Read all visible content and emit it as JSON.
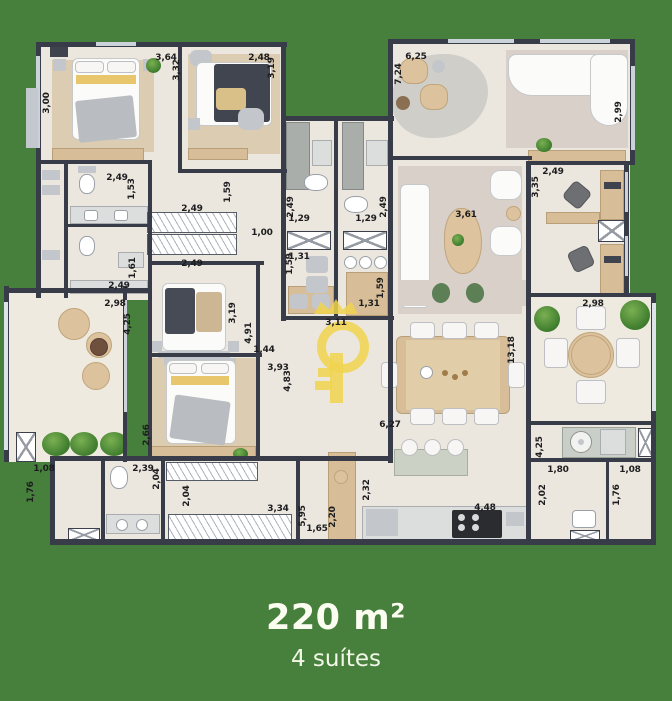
{
  "colors": {
    "background": "#47803c",
    "walls": "#373c48",
    "floor": "#ece7de",
    "watermark": "#f1d44e"
  },
  "footer": {
    "area": "220 m²",
    "suites": "4 suítes"
  },
  "dim_labels": [
    {
      "t": "3,00",
      "x": 47,
      "y": 103,
      "v": 1
    },
    {
      "t": "3,64",
      "x": 166,
      "y": 58,
      "v": 0
    },
    {
      "t": "3,32",
      "x": 177,
      "y": 70,
      "v": 1
    },
    {
      "t": "2,48",
      "x": 259,
      "y": 58,
      "v": 0
    },
    {
      "t": "3,19",
      "x": 272,
      "y": 68,
      "v": 1
    },
    {
      "t": "6,25",
      "x": 416,
      "y": 57,
      "v": 0
    },
    {
      "t": "7,24",
      "x": 399,
      "y": 74,
      "v": 1
    },
    {
      "t": "2,99",
      "x": 619,
      "y": 112,
      "v": 1
    },
    {
      "t": "2,49",
      "x": 553,
      "y": 172,
      "v": 0
    },
    {
      "t": "3,35",
      "x": 536,
      "y": 187,
      "v": 1
    },
    {
      "t": "3,61",
      "x": 466,
      "y": 215,
      "v": 0
    },
    {
      "t": "2,98",
      "x": 593,
      "y": 304,
      "v": 0
    },
    {
      "t": "13,18",
      "x": 512,
      "y": 350,
      "v": 1
    },
    {
      "t": "4,25",
      "x": 540,
      "y": 447,
      "v": 1
    },
    {
      "t": "1,80",
      "x": 558,
      "y": 470,
      "v": 0
    },
    {
      "t": "2,02",
      "x": 543,
      "y": 495,
      "v": 1
    },
    {
      "t": "1,08",
      "x": 630,
      "y": 470,
      "v": 0
    },
    {
      "t": "1,76",
      "x": 617,
      "y": 495,
      "v": 1
    },
    {
      "t": "2,49",
      "x": 117,
      "y": 178,
      "v": 0
    },
    {
      "t": "1,53",
      "x": 132,
      "y": 189,
      "v": 1
    },
    {
      "t": "2,49",
      "x": 119,
      "y": 286,
      "v": 0
    },
    {
      "t": "1,61",
      "x": 133,
      "y": 268,
      "v": 1
    },
    {
      "t": "2,49",
      "x": 192,
      "y": 209,
      "v": 0
    },
    {
      "t": "2,49",
      "x": 192,
      "y": 264,
      "v": 0
    },
    {
      "t": "1,59",
      "x": 228,
      "y": 192,
      "v": 1
    },
    {
      "t": "1,00",
      "x": 262,
      "y": 233,
      "v": 0
    },
    {
      "t": "2,49",
      "x": 291,
      "y": 207,
      "v": 1
    },
    {
      "t": "1,29",
      "x": 299,
      "y": 219,
      "v": 0
    },
    {
      "t": "2,49",
      "x": 384,
      "y": 207,
      "v": 1
    },
    {
      "t": "1,29",
      "x": 366,
      "y": 219,
      "v": 0
    },
    {
      "t": "1,31",
      "x": 299,
      "y": 257,
      "v": 0
    },
    {
      "t": "1,59",
      "x": 290,
      "y": 264,
      "v": 1
    },
    {
      "t": "1,31",
      "x": 369,
      "y": 304,
      "v": 0
    },
    {
      "t": "1,59",
      "x": 381,
      "y": 288,
      "v": 1
    },
    {
      "t": "2,98",
      "x": 115,
      "y": 304,
      "v": 0
    },
    {
      "t": "4,25",
      "x": 128,
      "y": 324,
      "v": 1
    },
    {
      "t": "3,19",
      "x": 233,
      "y": 313,
      "v": 1
    },
    {
      "t": "4,91",
      "x": 249,
      "y": 333,
      "v": 1
    },
    {
      "t": "1,44",
      "x": 264,
      "y": 350,
      "v": 0
    },
    {
      "t": "3,93",
      "x": 278,
      "y": 368,
      "v": 0
    },
    {
      "t": "4,83",
      "x": 288,
      "y": 381,
      "v": 1
    },
    {
      "t": "3,11",
      "x": 336,
      "y": 323,
      "v": 0
    },
    {
      "t": "2,66",
      "x": 147,
      "y": 435,
      "v": 1
    },
    {
      "t": "1,08",
      "x": 44,
      "y": 469,
      "v": 0
    },
    {
      "t": "1,76",
      "x": 31,
      "y": 492,
      "v": 1
    },
    {
      "t": "2,39",
      "x": 143,
      "y": 469,
      "v": 0
    },
    {
      "t": "2,04",
      "x": 157,
      "y": 479,
      "v": 1
    },
    {
      "t": "2,04",
      "x": 187,
      "y": 496,
      "v": 1
    },
    {
      "t": "3,34",
      "x": 278,
      "y": 509,
      "v": 0
    },
    {
      "t": "5,95",
      "x": 303,
      "y": 516,
      "v": 1
    },
    {
      "t": "1,65",
      "x": 317,
      "y": 529,
      "v": 0
    },
    {
      "t": "2,20",
      "x": 333,
      "y": 517,
      "v": 1
    },
    {
      "t": "2,32",
      "x": 367,
      "y": 490,
      "v": 1
    },
    {
      "t": "6,27",
      "x": 390,
      "y": 425,
      "v": 0
    },
    {
      "t": "4,48",
      "x": 485,
      "y": 508,
      "v": 0
    }
  ]
}
